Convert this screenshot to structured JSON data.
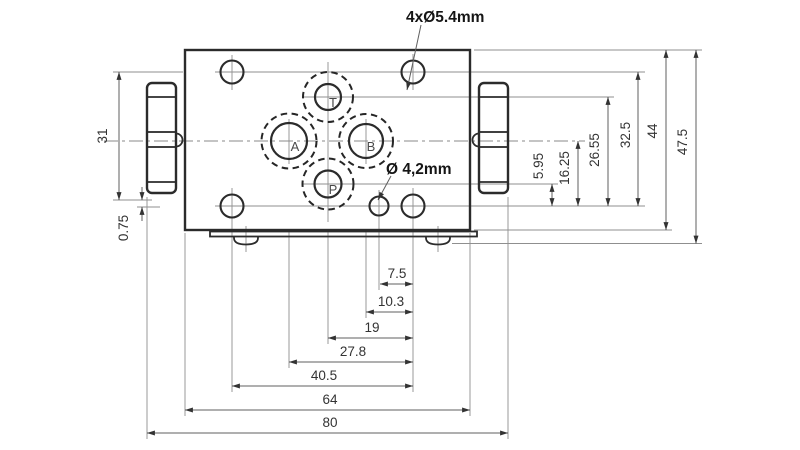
{
  "drawing": {
    "callouts": {
      "mounting_holes": "4xØ5.4mm",
      "orifice": "Ø 4,2mm"
    },
    "port_labels": {
      "a": "A",
      "b": "B",
      "t": "T",
      "p": "P"
    },
    "dims": {
      "left": [
        "31",
        "0.75"
      ],
      "right": [
        "5.95",
        "16.25",
        "26.55",
        "32.5",
        "44",
        "47.5"
      ],
      "bottom": [
        "7.5",
        "10.3",
        "19",
        "27.8",
        "40.5",
        "64",
        "80"
      ]
    },
    "colors": {
      "outline": "#2b2b2b",
      "thin_line": "#8f8f8f",
      "dimension_line": "#5f5f5f",
      "text": "#333333",
      "background": "#ffffff"
    }
  }
}
